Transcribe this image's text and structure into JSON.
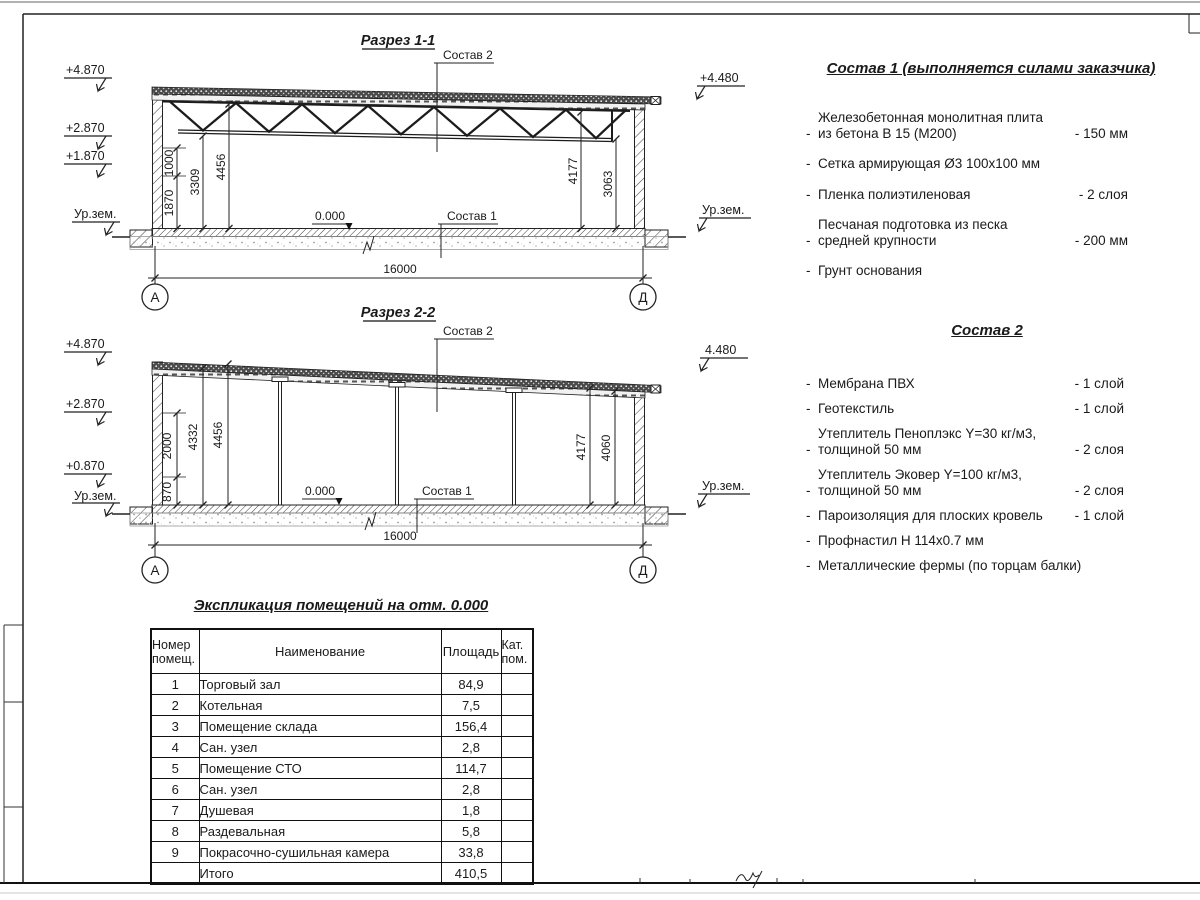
{
  "section1": {
    "title": "Разрез 1-1",
    "sostav2_label": "Состав 2",
    "sostav1_label": "Состав 1",
    "zero_label": "0.000",
    "elevations": {
      "l1": "+4.870",
      "l2": "+2.870",
      "l3": "+1.870",
      "lg": "Ур.зем.",
      "r1": "+4.480",
      "rg": "Ур.зем."
    },
    "dims": {
      "d1": "1870",
      "d2": "1000",
      "d3": "3309",
      "d4": "4456",
      "d5": "4177",
      "d6": "3063",
      "span": "16000"
    },
    "axes": {
      "left": "А",
      "right": "Д"
    }
  },
  "section2": {
    "title": "Разрез 2-2",
    "sostav2_label": "Состав 2",
    "sostav1_label": "Состав 1",
    "zero_label": "0.000",
    "elevations": {
      "l1": "+4.870",
      "l2": "+2.870",
      "l3": "+0.870",
      "lg": "Ур.зем.",
      "r1": "4.480",
      "rg": "Ур.зем."
    },
    "dims": {
      "d1": "870",
      "d2": "2000",
      "d3": "4332",
      "d4": "4456",
      "d5": "4177",
      "d6": "4060",
      "span": "16000"
    },
    "axes": {
      "left": "А",
      "right": "Д"
    }
  },
  "sostav1": {
    "title": "Состав 1 (выполняется силами заказчика)",
    "dash": "-",
    "items": [
      {
        "line1": "Железобетонная  монолитная плита",
        "line2": "из бетона В 15 (М200)",
        "value": "- 150 мм"
      },
      {
        "line1": "Сетка армирующая Ø3 100х100 мм",
        "line2": "",
        "value": ""
      },
      {
        "line1": "Пленка полиэтиленовая",
        "line2": "",
        "value": "-  2 слоя"
      },
      {
        "line1": "Песчаная подготовка из песка",
        "line2": "средней крупности",
        "value": "- 200 мм"
      },
      {
        "line1": "Грунт основания",
        "line2": "",
        "value": ""
      }
    ]
  },
  "sostav2": {
    "title": "Состав 2",
    "dash": "-",
    "items": [
      {
        "line1": "Мембрана ПВХ",
        "line2": "",
        "value": "- 1 слой"
      },
      {
        "line1": "Геотекстиль",
        "line2": "",
        "value": "- 1 слой"
      },
      {
        "line1": "Утеплитель Пеноплэкс Y=30 кг/м3,",
        "line2": "толщиной 50 мм",
        "value": "- 2 слоя"
      },
      {
        "line1": "Утеплитель Эковер Y=100 кг/м3,",
        "line2": "толщиной 50 мм",
        "value": "- 2 слоя"
      },
      {
        "line1": "Пароизоляция для плоских кровель",
        "line2": "",
        "value": "- 1 слой"
      },
      {
        "line1": "Профнастил Н 114х0.7 мм",
        "line2": "",
        "value": ""
      },
      {
        "line1": "Металлические фермы (по торцам балки)",
        "line2": "",
        "value": ""
      }
    ]
  },
  "explication": {
    "title": "Экспликация помещений на отм. 0.000",
    "headers": {
      "num1": "Номер",
      "num2": "помещ.",
      "name": "Наименование",
      "area": "Площадь",
      "cat1": "Кат.",
      "cat2": "пом."
    },
    "rows": [
      {
        "num": "1",
        "name": "Торговый зал",
        "area": "84,9",
        "cat": ""
      },
      {
        "num": "2",
        "name": "Котельная",
        "area": "7,5",
        "cat": ""
      },
      {
        "num": "3",
        "name": "Помещение склада",
        "area": "156,4",
        "cat": ""
      },
      {
        "num": "4",
        "name": "Сан. узел",
        "area": "2,8",
        "cat": ""
      },
      {
        "num": "5",
        "name": "Помещение СТО",
        "area": "114,7",
        "cat": ""
      },
      {
        "num": "6",
        "name": "Сан. узел",
        "area": "2,8",
        "cat": ""
      },
      {
        "num": "7",
        "name": "Душевая",
        "area": "1,8",
        "cat": ""
      },
      {
        "num": "8",
        "name": "Раздевальная",
        "area": "5,8",
        "cat": ""
      },
      {
        "num": "9",
        "name": "Покрасочно-сушильная камера",
        "area": "33,8",
        "cat": ""
      },
      {
        "num": "",
        "name": "Итого",
        "area": "410,5",
        "cat": ""
      }
    ]
  }
}
